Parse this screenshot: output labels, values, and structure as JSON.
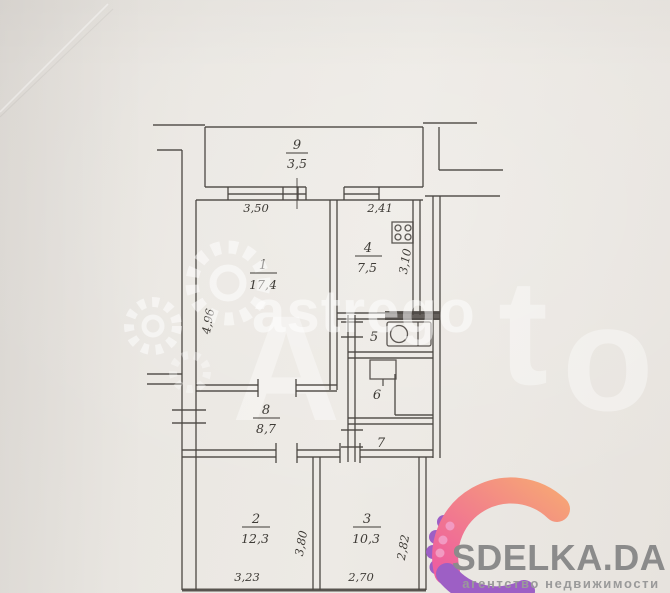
{
  "plan": {
    "balcony": {
      "number": "9",
      "area": "3,5"
    },
    "room1": {
      "number": "1",
      "area": "17,4"
    },
    "kitchen": {
      "number": "4",
      "area": "7,5"
    },
    "bath": {
      "number": "5"
    },
    "toilet": {
      "number": "6"
    },
    "room7": {
      "number": "7"
    },
    "hall": {
      "number": "8",
      "area": "8,7"
    },
    "room2": {
      "number": "2",
      "area": "12,3"
    },
    "room3": {
      "number": "3",
      "area": "10,3"
    },
    "dims": {
      "room1_width": "3,50",
      "kitchen_width": "2,41",
      "room1_height": "4,96",
      "kitchen_height": "3,10",
      "room2_height": "3,80",
      "room3_height": "2,82",
      "room2_width": "3,23",
      "room3_width": "2,70"
    }
  },
  "watermark": {
    "agency": "astrego",
    "big_a": "A",
    "big_t": "t",
    "big_o": "o"
  },
  "logo": {
    "title": "SDELKA.DA",
    "tagline": "агентство недвижимости"
  },
  "colors": {
    "plan_line": "#4b4742",
    "paper": "#eae7e2",
    "logo_text": "#8b8b8b",
    "logo_orange": "#f6a476",
    "logo_pink": "#ee5f9e",
    "logo_purple": "#9d5fc5"
  }
}
